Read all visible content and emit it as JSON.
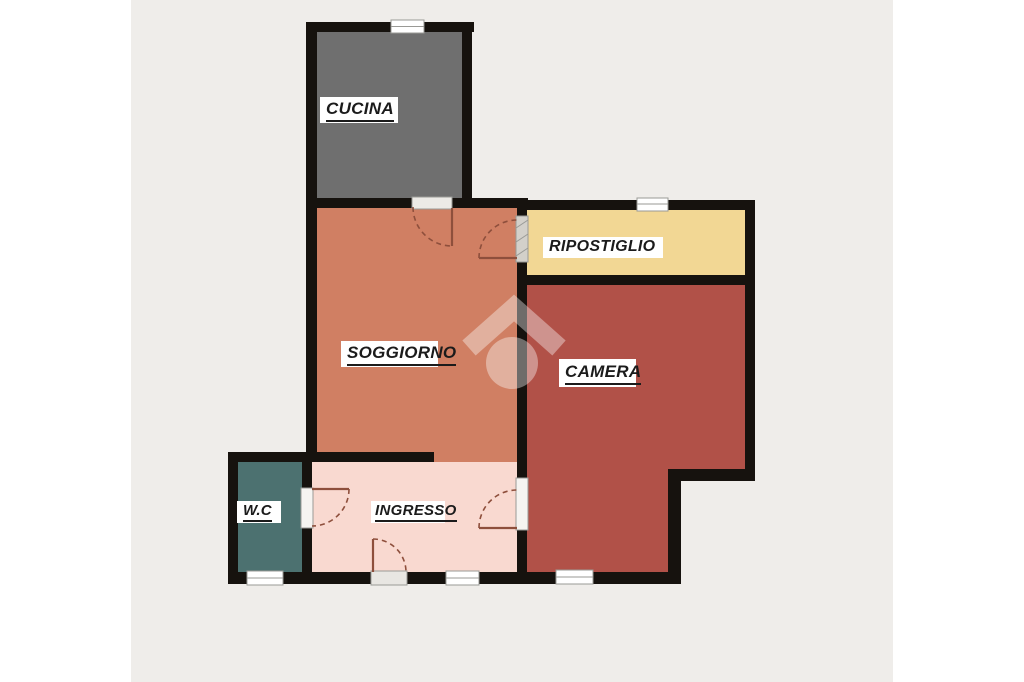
{
  "canvas": {
    "background": "#ffffff",
    "plan_background": "#efedea",
    "wall_color": "#16120e",
    "window_fill": "#ffffff",
    "door_arc_color": "#8e4f3c"
  },
  "watermark": {
    "icon": "house-logo-icon",
    "color": "#ffffff",
    "opacity": "0.38"
  },
  "rooms": {
    "cucina": {
      "label": "CUCINA",
      "color": "#6f6f6f"
    },
    "soggiorno": {
      "label": "SOGGIORNO",
      "color": "#d07f63"
    },
    "ripostiglio": {
      "label": "RIPOSTIGLIO",
      "color": "#f2d794"
    },
    "camera": {
      "label": "CAMERA",
      "color": "#b15148"
    },
    "ingresso": {
      "label": "INGRESSO",
      "color": "#f9d9d0"
    },
    "wc": {
      "label": "W.C",
      "color": "#4c7170"
    }
  }
}
